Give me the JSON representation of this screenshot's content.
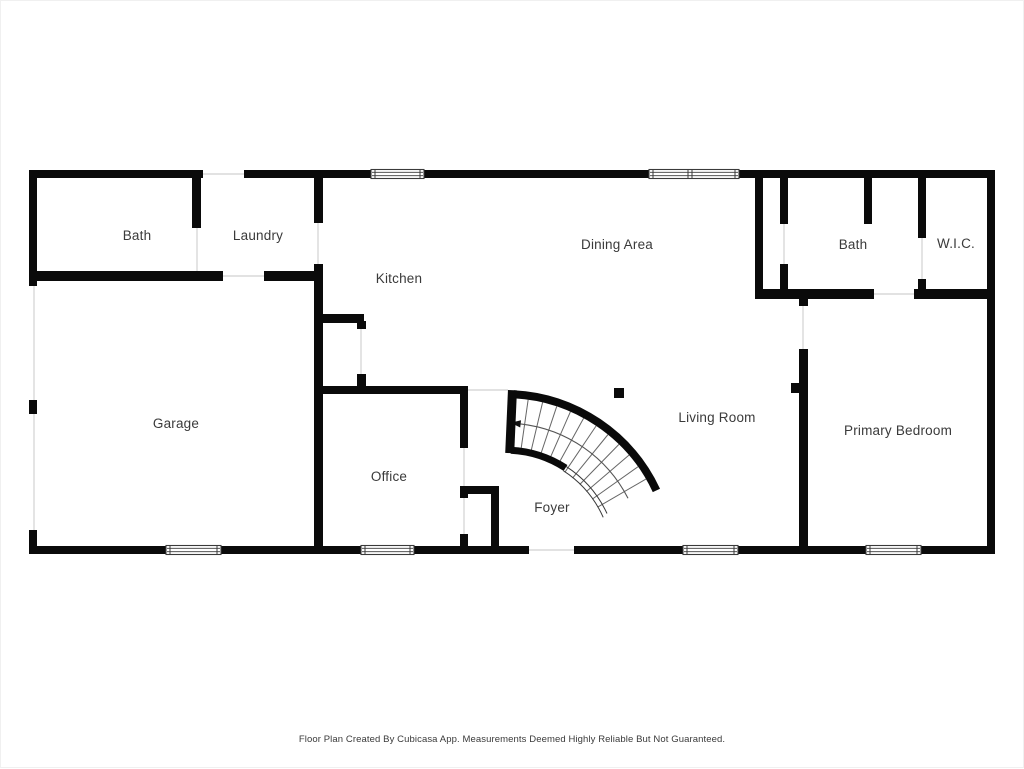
{
  "footer": {
    "disclaimer": "Floor Plan Created By Cubicasa App. Measurements Deemed Highly Reliable But Not Guaranteed."
  },
  "floorplan": {
    "wall_color": "#0a0a0a",
    "label_color": "#3a3a3a",
    "threshold_color": "#d9d9d9",
    "window_frame_color": "#3a3a3a",
    "rooms": [
      {
        "id": "bath-left",
        "label": "Bath",
        "cx": 136,
        "cy": 239
      },
      {
        "id": "laundry",
        "label": "Laundry",
        "cx": 257,
        "cy": 239
      },
      {
        "id": "kitchen",
        "label": "Kitchen",
        "cx": 398,
        "cy": 282
      },
      {
        "id": "dining-area",
        "label": "Dining Area",
        "cx": 616,
        "cy": 248
      },
      {
        "id": "bath-right",
        "label": "Bath",
        "cx": 852,
        "cy": 248
      },
      {
        "id": "wic",
        "label": "W.I.C.",
        "cx": 955,
        "cy": 247
      },
      {
        "id": "garage",
        "label": "Garage",
        "cx": 175,
        "cy": 427
      },
      {
        "id": "office",
        "label": "Office",
        "cx": 388,
        "cy": 480
      },
      {
        "id": "foyer",
        "label": "Foyer",
        "cx": 551,
        "cy": 511
      },
      {
        "id": "living-room",
        "label": "Living Room",
        "cx": 716,
        "cy": 421
      },
      {
        "id": "primary-bedroom",
        "label": "Primary Bedroom",
        "cx": 897,
        "cy": 434
      }
    ],
    "walls": [
      [
        28,
        169,
        174,
        8
      ],
      [
        243,
        169,
        127,
        8
      ],
      [
        423,
        169,
        225,
        8
      ],
      [
        738,
        169,
        256,
        8
      ],
      [
        28,
        545,
        137,
        8
      ],
      [
        220,
        545,
        140,
        8
      ],
      [
        413,
        545,
        115,
        8
      ],
      [
        573,
        545,
        109,
        8
      ],
      [
        737,
        545,
        128,
        8
      ],
      [
        920,
        545,
        74,
        8
      ],
      [
        28,
        169,
        8,
        116
      ],
      [
        28,
        399,
        8,
        14
      ],
      [
        28,
        529,
        8,
        24
      ],
      [
        986,
        169,
        8,
        384
      ],
      [
        191,
        169,
        9,
        58
      ],
      [
        28,
        270,
        194,
        10
      ],
      [
        263,
        270,
        59,
        10
      ],
      [
        313,
        177,
        9,
        45
      ],
      [
        313,
        263,
        9,
        282
      ],
      [
        322,
        313,
        41,
        9
      ],
      [
        356,
        320,
        9,
        8
      ],
      [
        356,
        373,
        9,
        14
      ],
      [
        322,
        385,
        145,
        8
      ],
      [
        459,
        393,
        8,
        54
      ],
      [
        459,
        485,
        8,
        12
      ],
      [
        459,
        533,
        8,
        12
      ],
      [
        467,
        485,
        31,
        8
      ],
      [
        490,
        493,
        8,
        52
      ],
      [
        754,
        177,
        8,
        116
      ],
      [
        779,
        177,
        8,
        46
      ],
      [
        779,
        263,
        8,
        25
      ],
      [
        863,
        177,
        8,
        46
      ],
      [
        917,
        177,
        8,
        60
      ],
      [
        917,
        278,
        8,
        12
      ],
      [
        754,
        288,
        119,
        10
      ],
      [
        913,
        288,
        81,
        10
      ],
      [
        798,
        293,
        9,
        12
      ],
      [
        798,
        348,
        9,
        197
      ],
      [
        790,
        382,
        8,
        10
      ]
    ],
    "windows": [
      {
        "x": 370,
        "y": 169,
        "w": 53,
        "h": 8,
        "dividers": []
      },
      {
        "x": 648,
        "y": 169,
        "w": 90,
        "h": 8,
        "dividers": [
          689
        ]
      },
      {
        "x": 165,
        "y": 545,
        "w": 55,
        "h": 8,
        "dividers": []
      },
      {
        "x": 360,
        "y": 545,
        "w": 53,
        "h": 8,
        "dividers": []
      },
      {
        "x": 682,
        "y": 545,
        "w": 55,
        "h": 8,
        "dividers": []
      },
      {
        "x": 865,
        "y": 545,
        "w": 55,
        "h": 8,
        "dividers": []
      }
    ],
    "thresholds": [
      [
        202,
        173,
        243,
        173
      ],
      [
        33,
        285,
        33,
        529
      ],
      [
        196,
        227,
        196,
        270
      ],
      [
        222,
        275,
        263,
        275
      ],
      [
        317,
        222,
        317,
        263
      ],
      [
        360,
        328,
        360,
        373
      ],
      [
        463,
        447,
        463,
        485
      ],
      [
        463,
        497,
        463,
        533
      ],
      [
        467,
        389,
        507,
        389
      ],
      [
        528,
        549,
        573,
        549
      ],
      [
        783,
        223,
        783,
        263
      ],
      [
        873,
        293,
        913,
        293
      ],
      [
        921,
        237,
        921,
        278
      ],
      [
        802,
        305,
        802,
        348
      ]
    ],
    "post": {
      "x": 613,
      "y": 387,
      "size": 10
    },
    "stairs": {
      "cx": 504,
      "cy": 560,
      "outer_r": 167,
      "outer_stroke": 8,
      "inner_r": 111,
      "inner_stroke": 7,
      "start_deg": -87,
      "end_deg": -25,
      "thin_from_deg": -57,
      "steps": 12,
      "walk_r": 138,
      "walk_start_deg": -83.5,
      "walk_end_deg": -27
    }
  }
}
